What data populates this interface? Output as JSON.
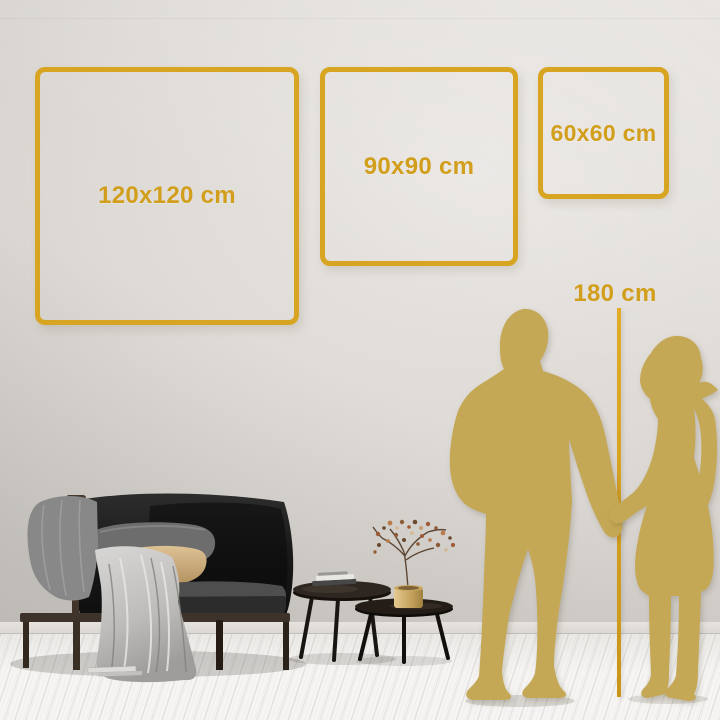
{
  "size_guide": {
    "squares": [
      {
        "id": "large",
        "label": "120x120 cm"
      },
      {
        "id": "medium",
        "label": "90x90 cm"
      },
      {
        "id": "small",
        "label": "60x60 cm"
      }
    ],
    "height_marker": {
      "label": "180 cm"
    }
  },
  "colors": {
    "accent_gold": "#D8A522",
    "label_gold": "#D29F1C",
    "silhouette_gold": "#C5A855",
    "wall": "#DDD9D5",
    "floor": "#F4F3F1"
  },
  "scene_objects": {
    "figures": [
      "man-silhouette",
      "woman-silhouette"
    ],
    "furniture": [
      "sofa",
      "throw-blanket",
      "gray-pillow",
      "tan-pillow",
      "nesting-coffee-tables",
      "books",
      "brass-vase-with-dried-branch"
    ]
  }
}
